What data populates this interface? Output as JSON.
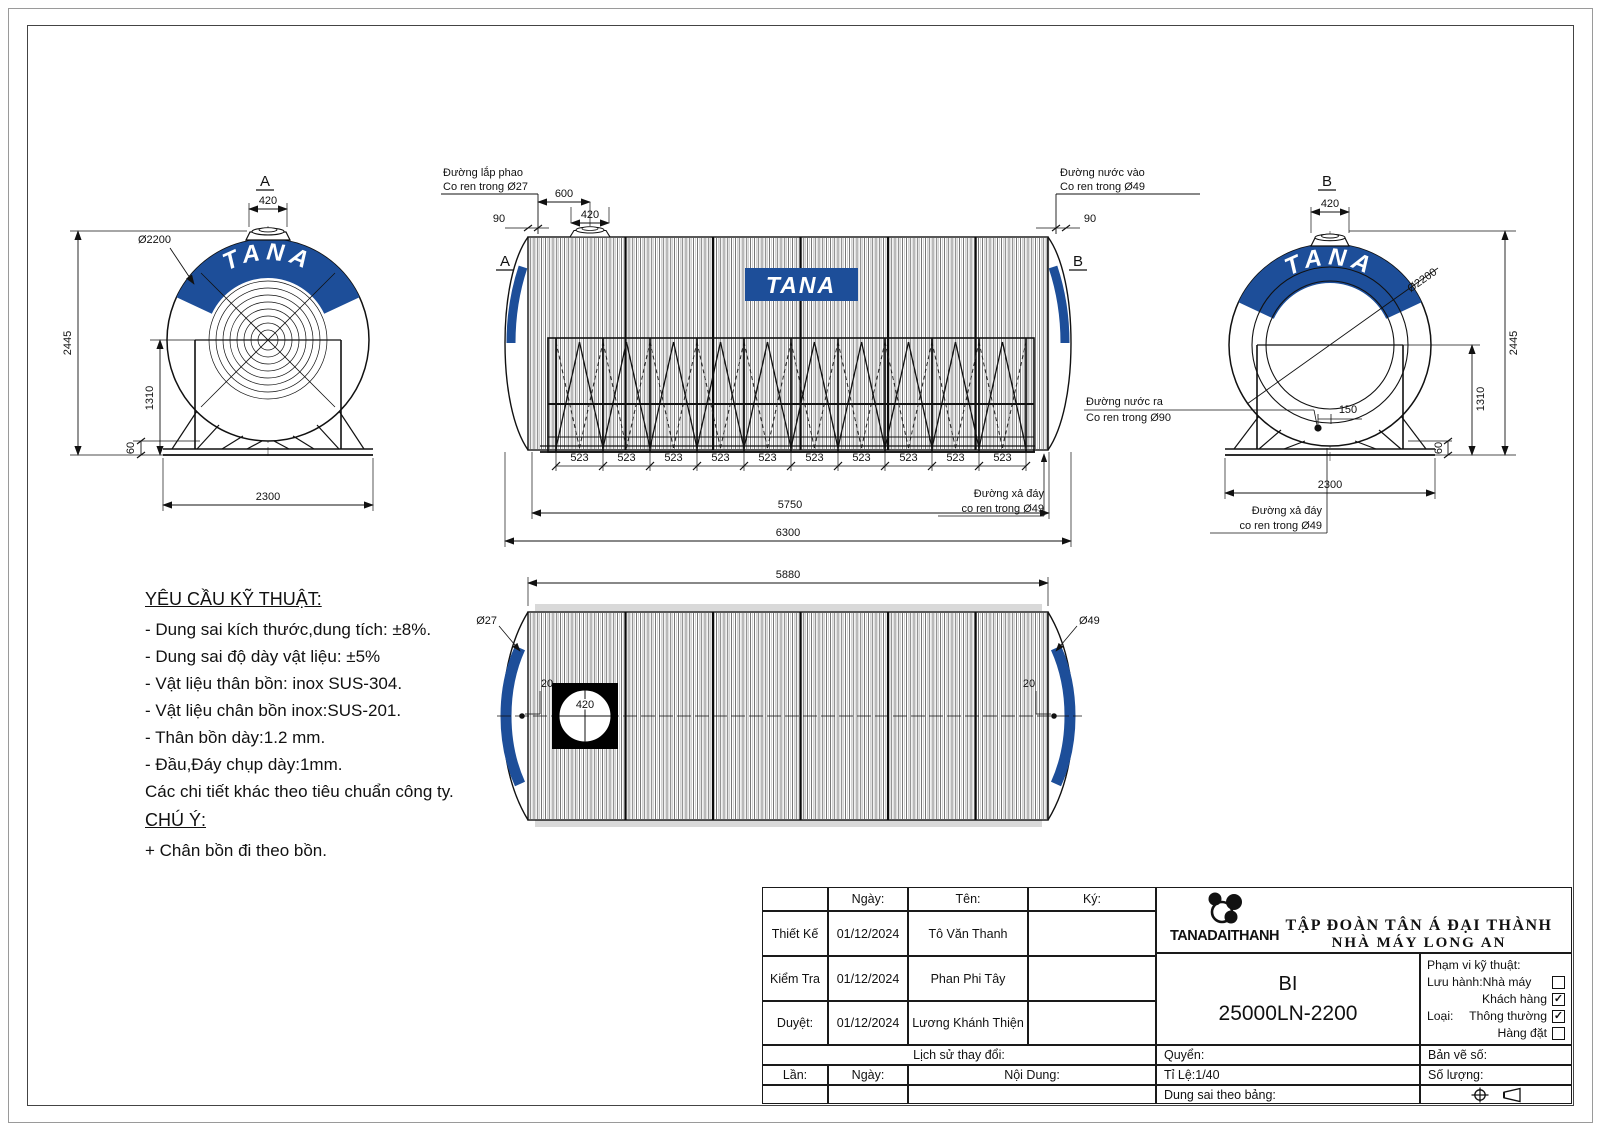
{
  "brand": "TANA",
  "views": {
    "left": {
      "label": "A",
      "d420": "420",
      "dia": "Ø2200",
      "h2445": "2445",
      "h1310": "1310",
      "h60": "60",
      "base": "2300"
    },
    "front": {
      "label_a": "A",
      "label_b": "B",
      "float1": "Đường lắp phao",
      "float2": "Co ren trong Ø27",
      "in1": "Đường nước vào",
      "in2": "Co ren trong Ø49",
      "drain1": "Đường xả đáy",
      "drain2": "co ren trong Ø49",
      "d600": "600",
      "d90": "90",
      "d420": "420",
      "seg": "523",
      "d5750": "5750",
      "d6300": "6300"
    },
    "right": {
      "label": "B",
      "d420": "420",
      "dia": "Ø2200",
      "h2445": "2445",
      "h1310": "1310",
      "h60": "60",
      "d150": "150",
      "base": "2300",
      "out1": "Đường nước ra",
      "out2": "Co ren trong Ø90",
      "drain1": "Đường xả đáy",
      "drain2": "co ren trong Ø49"
    },
    "bottom": {
      "d5880": "5880",
      "d27": "Ø27",
      "d49": "Ø49",
      "d20": "20",
      "d420": "420"
    }
  },
  "notes": {
    "title": "YÊU CẦU KỸ THUẬT:",
    "lines": [
      "- Dung sai kích thước,dung tích: ±8%.",
      "- Dung sai độ dày vật liệu: ±5%",
      "- Vật liệu thân bồn: inox SUS-304.",
      "- Vật liệu chân bồn inox:SUS-201.",
      "- Thân bồn dày:1.2 mm.",
      "- Đầu,Đáy chụp dày:1mm.",
      "Các chi tiết khác theo tiêu chuẩn công ty."
    ],
    "note_title": "CHÚ Ý:",
    "note_line": "+ Chân bồn đi theo bồn."
  },
  "titleblock": {
    "header": {
      "ngay": "Ngày:",
      "ten": "Tên:",
      "ky": "Ký:"
    },
    "rows": [
      {
        "label": "Thiết Kế",
        "date": "01/12/2024",
        "name": "Tô Văn Thanh"
      },
      {
        "label": "Kiểm Tra",
        "date": "01/12/2024",
        "name": "Phan Phi Tây"
      },
      {
        "label": "Duyệt:",
        "date": "01/12/2024",
        "name": "Lương Khánh Thiện"
      }
    ],
    "history_label": "Lịch sử thay đổi:",
    "lan": "Lần:",
    "ngay2": "Ngày:",
    "noidung": "Nội Dung:",
    "company_line1": "TẬP ĐOÀN TÂN Á ĐẠI THÀNH",
    "company_line2": "NHÀ MÁY LONG AN",
    "logo_text": "TANADAITHANH",
    "model_code": "BI",
    "model_number": "25000LN-2200",
    "scope_title": "Phạm vi kỹ thuật:",
    "scope_rows": [
      {
        "prefix": "Lưu hành:",
        "label": "Nhà máy",
        "checked": false
      },
      {
        "prefix": "",
        "label": "Khách hàng",
        "checked": true
      },
      {
        "prefix": "Loại:",
        "label": "Thông thường",
        "checked": true
      },
      {
        "prefix": "",
        "label": "Hàng đặt",
        "checked": false
      }
    ],
    "check_glyph": "✓",
    "quyen": "Quyển:",
    "banveso": "Bản vẽ số:",
    "tile": "Tỉ Lệ:1/40",
    "soluong": "Số lượng:",
    "dungsai": "Dung sai theo bảng:"
  },
  "colors": {
    "brand_blue": "#1d4e99",
    "line": "#111111"
  }
}
